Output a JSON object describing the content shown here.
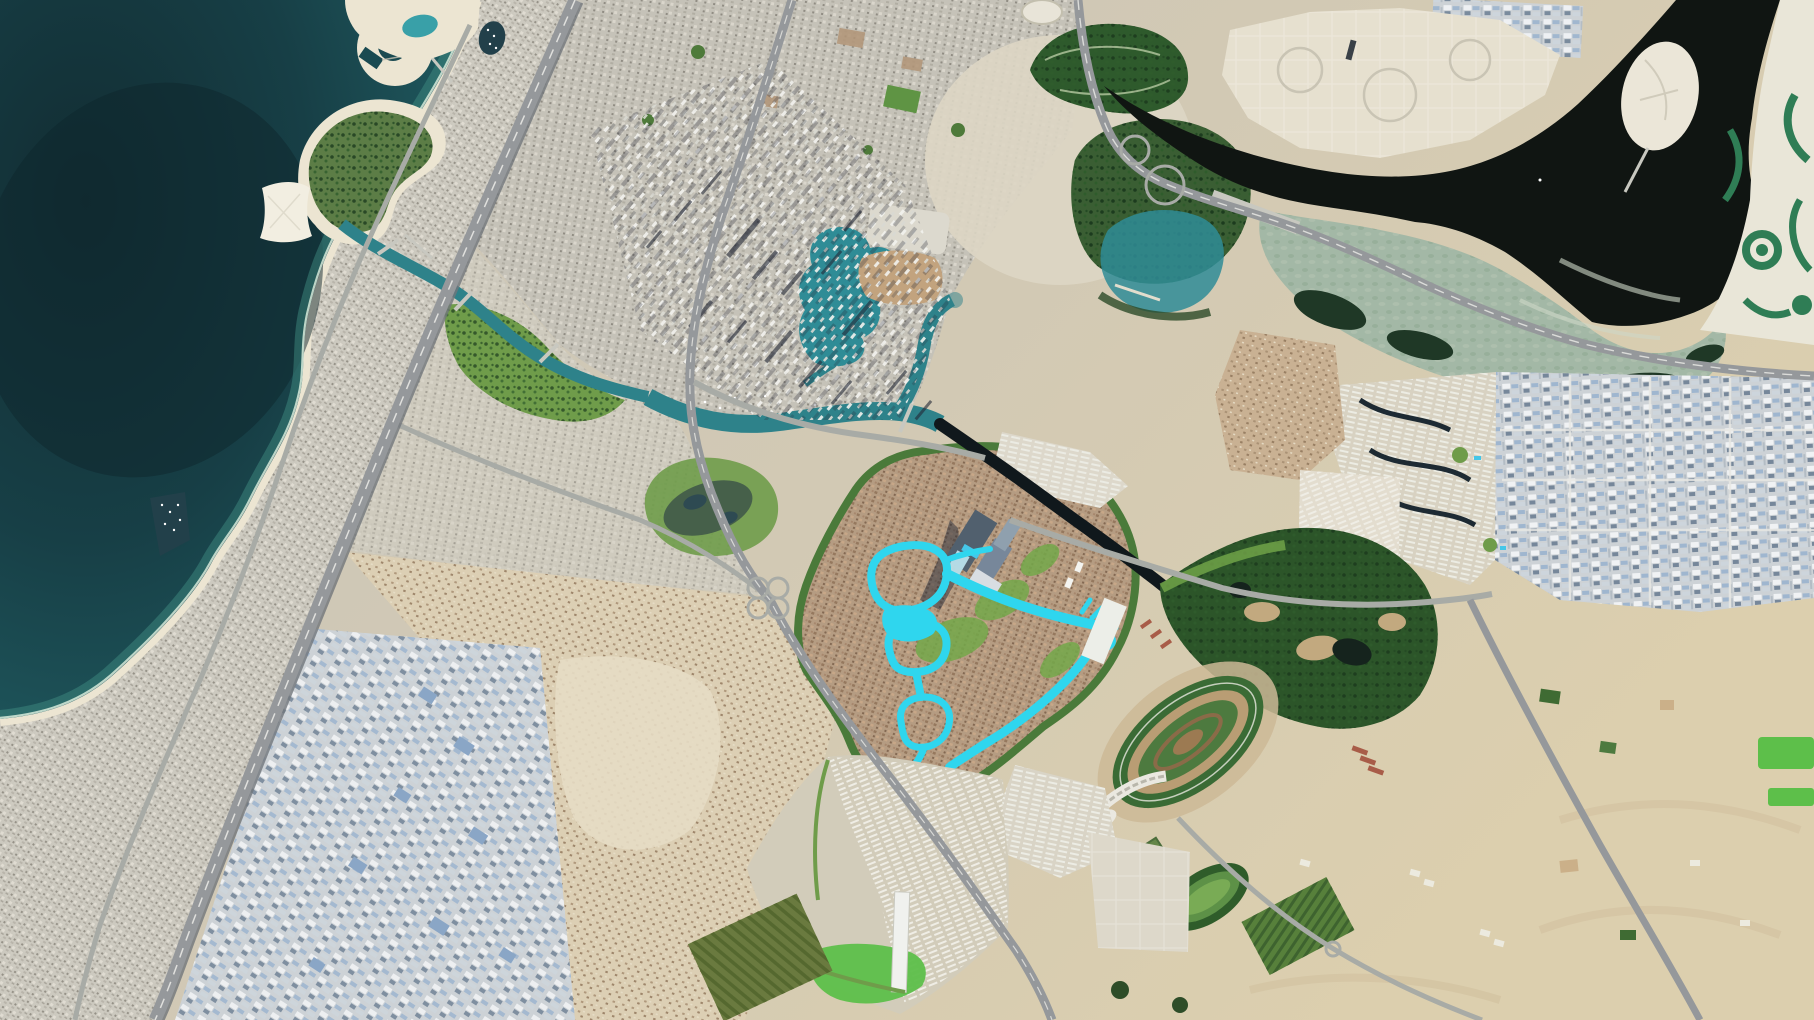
{
  "scene": {
    "type": "satellite-aerial-imagery",
    "view": "orthographic-top-down",
    "subject": "coastal-city-with-desert-inland"
  },
  "colors": {
    "sea_deep": "#12323a",
    "sea_mid": "#1a4a51",
    "sea_shallow": "#3d8a80",
    "deep_patch": "#0d262c",
    "surf": "#d8ecdc",
    "beach": "#ece5d2",
    "land_left": "#c8c5bb",
    "land_right": "#dccfae",
    "city_base": "#ccc9bf",
    "downtown_base": "#c5c2b8",
    "canal_zone_base": "#cfcbbe",
    "white_plots": "#e6e0cf",
    "plots_blob": "#ddd6c4",
    "shadow": "#232836",
    "tower_white": "#f1f1ec",
    "old_town": "#c2a37e",
    "mall_roof": "#dcd9ce",
    "canal_teal": "#2e828a",
    "lake_teal": "#2f8c96",
    "pool_blue": "#45c6e8",
    "cascade_white": "#bfe8f2",
    "lagoon_cyan": "#2fd6ee",
    "dark_canal": "#10181c",
    "creek_dark": "#101512",
    "milky_lagoon": "#a3b8a6",
    "mangrove": "#1f3826",
    "shoal": "#cfd8c8",
    "forest_green": "#3a5e33",
    "park_green": "#2e5a2c",
    "canal_park_green": "#6f9c4a",
    "lawn_green": "#74a84a",
    "bright_field": "#5dbf4a",
    "golf_green": "#2c5529",
    "golf_pond": "#15231d",
    "bunker_sand": "#c2a97f",
    "track_grass": "#3a6b35",
    "track_dirt": "#b99d74",
    "infield_green": "#4d7a3f",
    "apron_tan": "#cdb896",
    "grandstand": "#eae8e0",
    "d1_base": "#b59c82",
    "d1_belt": "#4a7a3a",
    "villa_sand": "#dccfb4",
    "empty_sand": "#e6dcc4",
    "desert": "#d8c8a6",
    "dune": "#cfbe9c",
    "industrial_base": "#cdd2d6",
    "industrial_blue": "#8aa6c6",
    "slate": "#5f6e7c",
    "tower_slate": "#51606e",
    "render_beige": "#d8d2c2",
    "render_canal_navy": "#1d2a33",
    "ne_dev_sand": "#e9e6d8",
    "channel_green": "#2f7d55",
    "road": "#95989b",
    "road_minor": "#a8aba6",
    "lane": "#e8e8e4",
    "bridge": "#c8c8c0",
    "boat": "#ffffff",
    "red_roof": "#a85c48",
    "pond_olive": "#46604a",
    "harbour_dark": "#22404a",
    "nursery_olive": "#6a7a3f",
    "field_green": "#57803b",
    "stadium_white": "#e8e4d8"
  },
  "features": [
    "sea",
    "deep-water-patch",
    "surf-line",
    "beach",
    "coastline",
    "pearl-peninsula",
    "peninsula-lagoon",
    "crescent-island",
    "seahorse-island",
    "butterfly-island",
    "island-bridge",
    "fishing-harbour",
    "harbour-boats",
    "coastal-city-grid",
    "inner-city-grid",
    "canal-district-grid",
    "top-city-brown-lots",
    "city-parks",
    "running-track",
    "zabeel-park",
    "stadium-oval",
    "white-plots-zone",
    "plot-roads",
    "water-canal",
    "canal-bridges",
    "canal-boats",
    "canal-park",
    "park-pond",
    "business-bay-canal",
    "downtown-lake",
    "downtown-mall",
    "old-town-district",
    "tower-shadows",
    "dark-canal",
    "mega-tower-complex",
    "tower-shadow",
    "cascade-pool",
    "district-development",
    "district-green-belt",
    "district-lawns",
    "crystal-lagoon",
    "lagoon-ring-a",
    "lagoon-ring-b",
    "lagoon-ring-c",
    "lagoon-right-arm",
    "lagoon-tail",
    "villa-strip-north",
    "white-villa-cluster",
    "render-community",
    "render-canals",
    "villa-render-community",
    "creek",
    "creek-island",
    "island-causeway",
    "creek-bridge",
    "creek-boats",
    "wildlife-lagoon",
    "mangroves",
    "shoal-streaks",
    "forest-park",
    "park-lake",
    "channel-development",
    "warehouse-grid",
    "industrial-grid",
    "industrial-roads",
    "bluebox-warehouses",
    "alquoz-industrial",
    "sandy-villas",
    "empty-lots",
    "golf-course",
    "golf-ponds",
    "sand-bunkers",
    "meydan-mall",
    "red-roof-rows",
    "racecourse",
    "racecourse-dirt-track",
    "racecourse-infield",
    "grandstand-arc",
    "training-track",
    "paddocks",
    "stable-fields",
    "hartland-development",
    "hartland-lawn",
    "long-white-building",
    "nursery-rows",
    "neighbor-cluster",
    "villa-community-se",
    "desert",
    "dune-streaks",
    "desert-farms",
    "bright-green-fields",
    "scattered-stables",
    "highway-sheikh-zayed",
    "metro-line",
    "highway-al-khail",
    "coast-road",
    "canal-south-road",
    "meydan-road",
    "highway-e44",
    "e44-interchange",
    "east-ring-road",
    "racecourse-road",
    "roundabout",
    "cloverleaf-interchange",
    "lane-markings"
  ]
}
